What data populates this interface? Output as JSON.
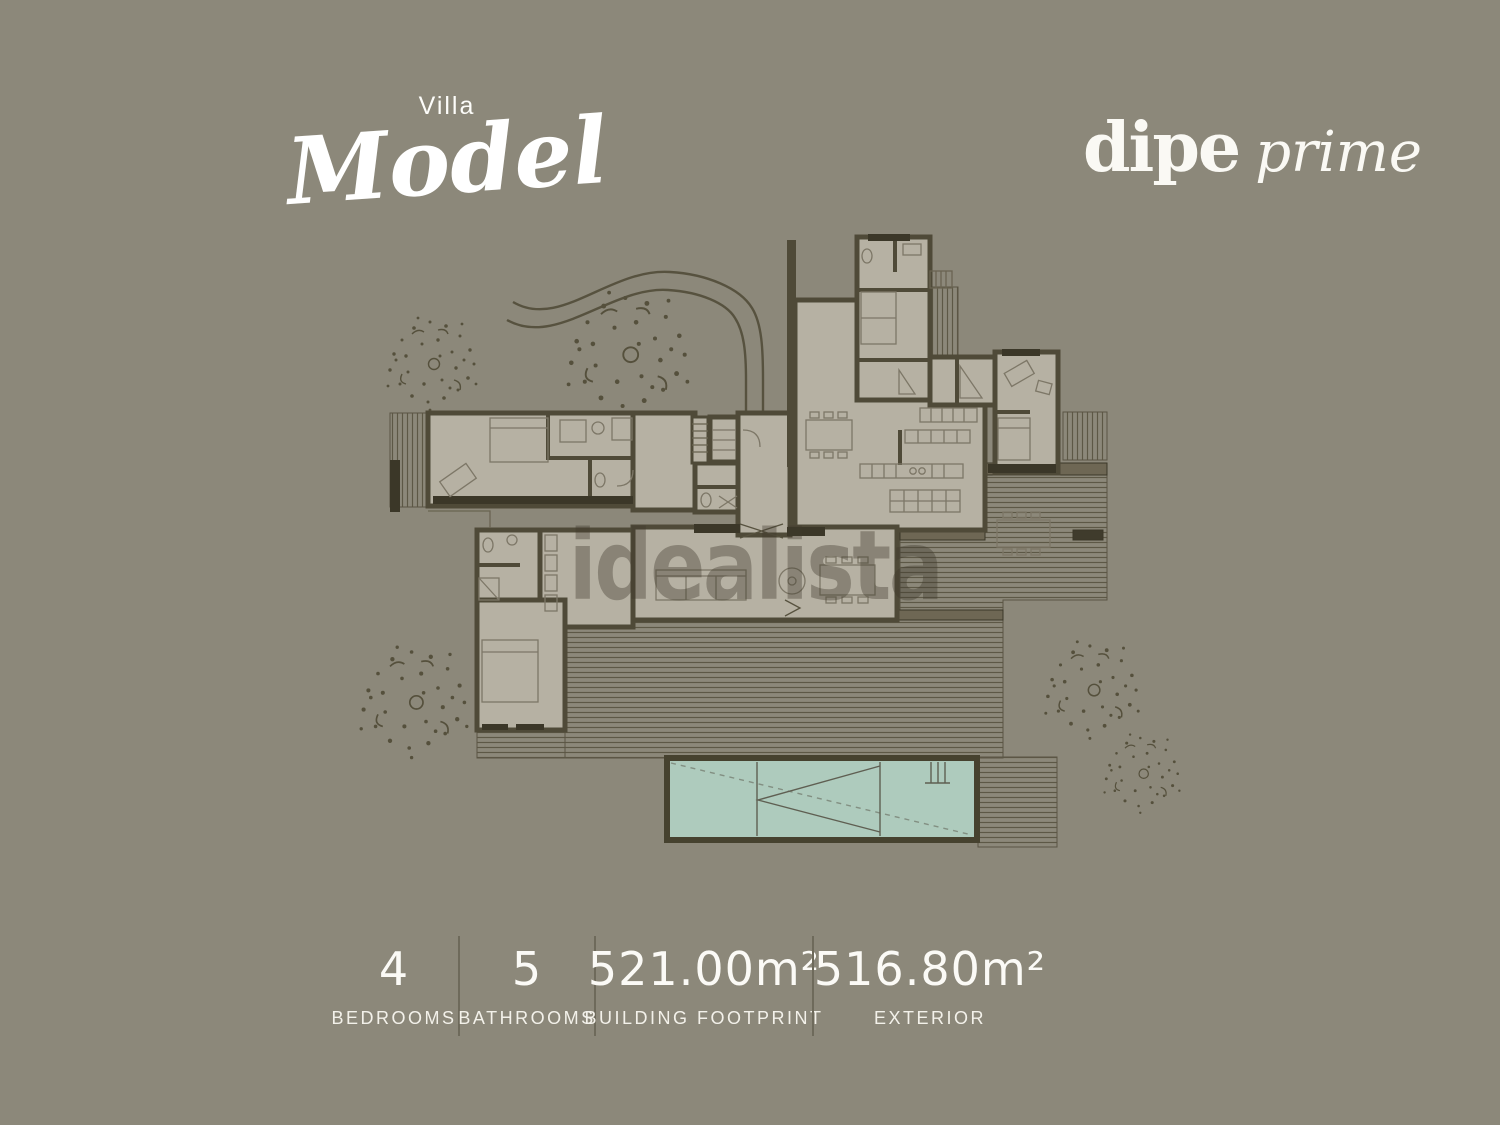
{
  "title": {
    "pre": "Villa",
    "name": "Model"
  },
  "brand": {
    "name": "dipe",
    "suffix": "prime"
  },
  "watermark": "idealista",
  "stats": [
    {
      "value": "4",
      "label": "BEDROOMS"
    },
    {
      "value": "5",
      "label": "BATHROOMS"
    },
    {
      "value": "521.00m²",
      "label": "BUILDING FOOTPRINT"
    },
    {
      "value": "516.80m²",
      "label": "EXTERIOR"
    }
  ],
  "colors": {
    "background": "#8c887a",
    "heading_text": "#ffffff",
    "stats_text": "#fbfaf6",
    "stats_divider": "#6e6a5b",
    "plan_room_fill": "#b6b1a3",
    "plan_wall_dark": "#4f4a38",
    "plan_wall_mid": "#6e6754",
    "deck_line": "#59543f",
    "pool_water": "#aecbbd",
    "tree": "#55503c",
    "watermark_color": "rgba(62,58,45,0.38)"
  }
}
